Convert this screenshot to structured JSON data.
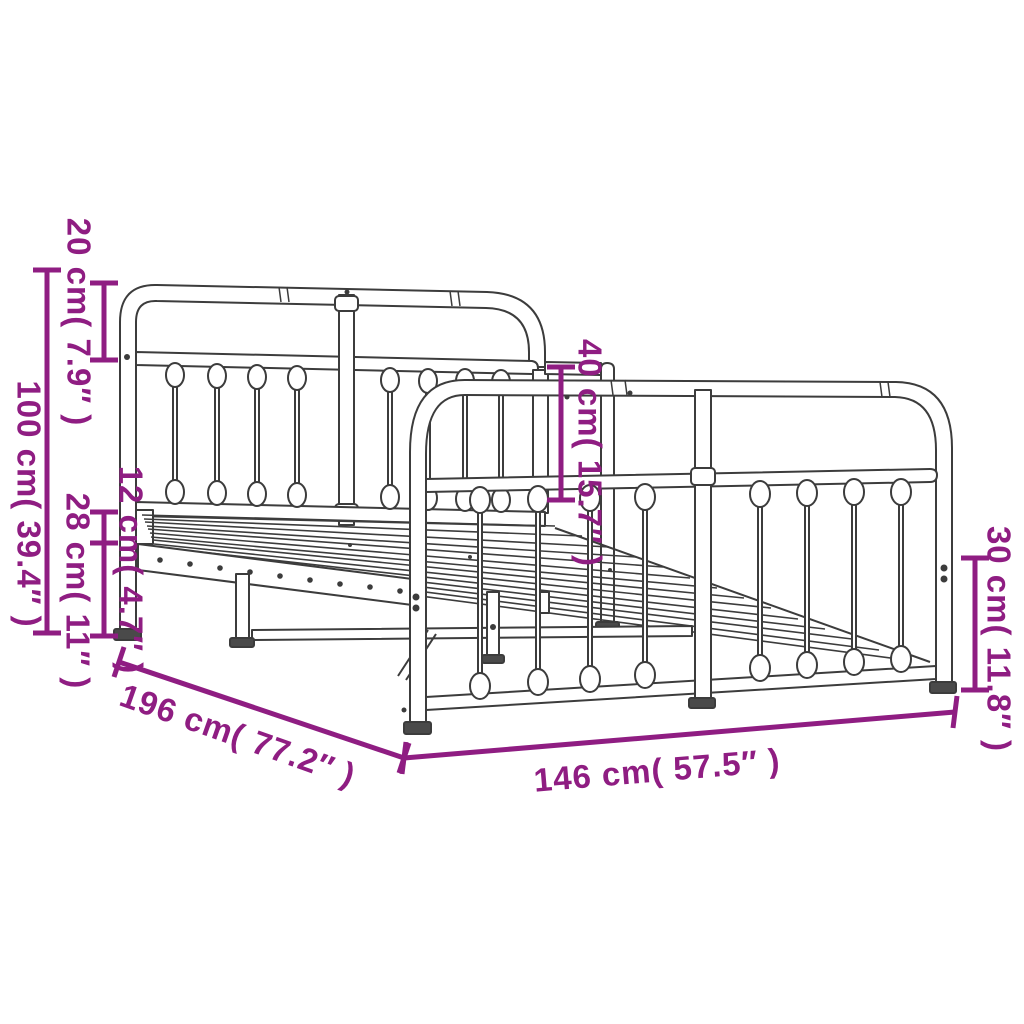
{
  "diagram": {
    "type": "product dimension diagram",
    "subject": "metal bed frame with curved headboard and footboard",
    "accent_color": "#8f1d82",
    "line_color": "#3c3c3c",
    "labels": {
      "overall_height": "100 cm( 39.4″ )",
      "headboard_top_section": "20 cm( 7.9″ )",
      "side_rail_height": "12 cm( 4.7″ )",
      "under_bed_clearance": "28 cm( 11″ )",
      "footboard_upper_section": "40 cm( 15.7″ )",
      "footboard_leg_height": "30 cm( 11.8″ )",
      "bed_length": "196 cm( 77.2″ )",
      "bed_width": "146 cm( 57.5″ )"
    }
  }
}
